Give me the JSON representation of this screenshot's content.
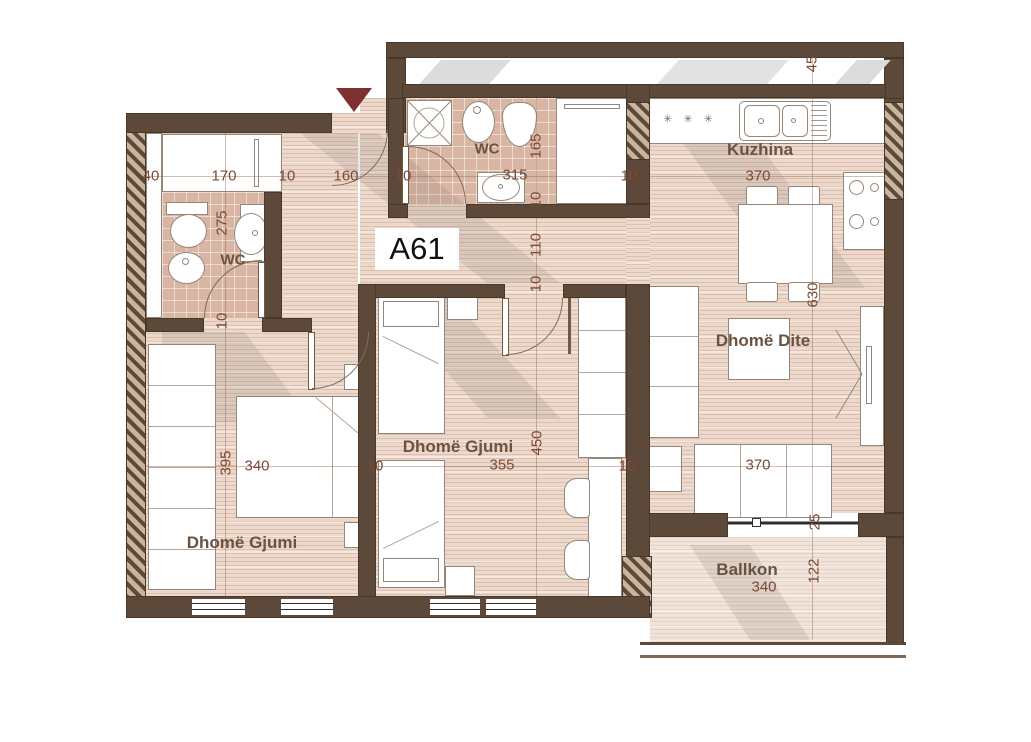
{
  "unit": {
    "label": "A61"
  },
  "rooms": {
    "wc_left": "WC",
    "wc_top": "WC",
    "kitchen": "Kuzhina",
    "living": "Dhomë Dite",
    "bedroom_mid": "Dhomë Gjumi",
    "bedroom_left": "Dhomë Gjumi",
    "balcony": "Ballkon"
  },
  "dims": {
    "top_chain": [
      "40",
      "170",
      "10",
      "160",
      "10",
      "315",
      "10"
    ],
    "kitchen_width": "370",
    "mid_chain": [
      "340",
      "10",
      "355",
      "10",
      "370"
    ],
    "balcony_width": "340",
    "wc_left_vertical": [
      "275",
      "10"
    ],
    "bedroom_left_height": "395",
    "center_vertical": [
      "165",
      "10",
      "110",
      "10",
      "450"
    ],
    "right_vertical": [
      "45",
      "630",
      "25",
      "122"
    ]
  },
  "symbols": {
    "kitchen_marks": "✳ ✳ ✳"
  }
}
